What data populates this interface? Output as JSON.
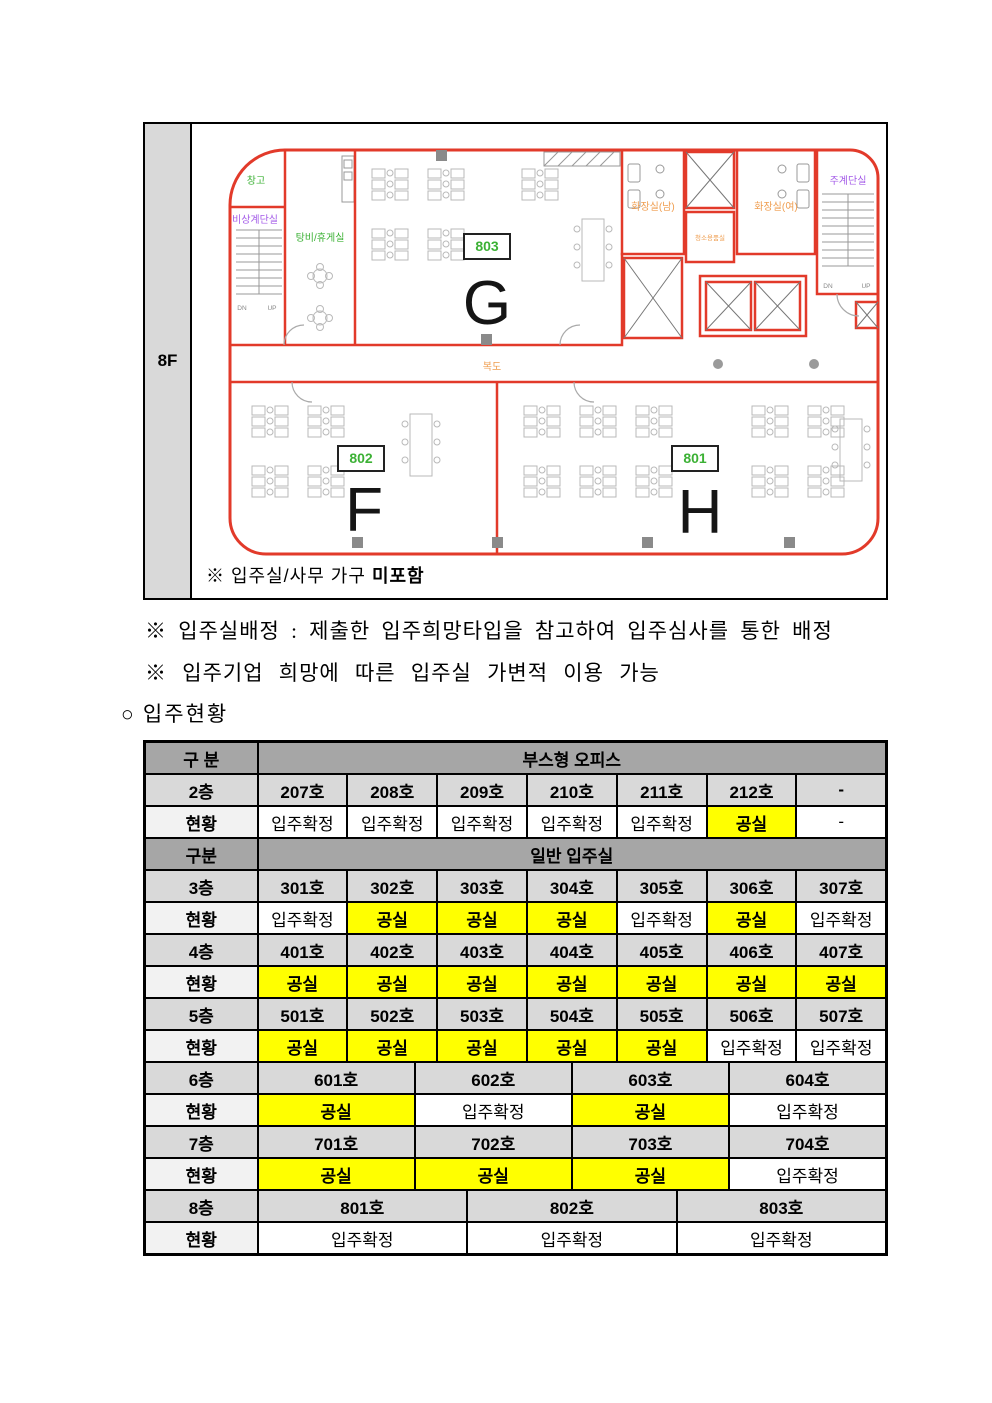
{
  "floor_plan": {
    "floor_label": "8F",
    "note": {
      "prefix": "※ 입주실/사무 가구 ",
      "bold": "미포함"
    },
    "labels": {
      "storage": "창고",
      "emergency_stairs": "비상계단실",
      "pantry": "탕비/휴게실",
      "toilet_men": "화장실(남)",
      "toilet_women": "화장실(여)",
      "cleaning_room": "청소용품실",
      "main_stairs": "주계단실",
      "corridor": "복도",
      "dn": "DN",
      "up": "UP"
    },
    "rooms": [
      {
        "number": "803",
        "letter": "G"
      },
      {
        "number": "802",
        "letter": "F"
      },
      {
        "number": "801",
        "letter": "H"
      }
    ],
    "colors": {
      "wall_red": "#e23a2a",
      "label_green": "#3cb135",
      "label_purple": "#a45ce8",
      "label_orange": "#ef9d4f",
      "furniture_gray": "#b9b9b9"
    }
  },
  "notes": [
    "※ 입주실배정 : 제출한 입주희망타입을 참고하여 입주심사를 통한 배정",
    "※ 입주기업 희망에 따른 입주실 가변적 이용 가능"
  ],
  "section_title": "○ 입주현황",
  "table": {
    "colors": {
      "header_bg": "#a6a6a6",
      "floor_bg": "#d9d9d9",
      "status_label_bg": "#f2f2f2",
      "vacant_bg": "#ffff00"
    },
    "rows": [
      {
        "type": "header",
        "label": "구 분",
        "value": "부스형 오피스"
      },
      {
        "type": "floors",
        "label": "2층",
        "cells": [
          {
            "t": "207호"
          },
          {
            "t": "208호"
          },
          {
            "t": "209호"
          },
          {
            "t": "210호"
          },
          {
            "t": "211호"
          },
          {
            "t": "212호"
          },
          {
            "t": "-"
          }
        ]
      },
      {
        "type": "status",
        "label": "현황",
        "cells": [
          {
            "t": "입주확정"
          },
          {
            "t": "입주확정"
          },
          {
            "t": "입주확정"
          },
          {
            "t": "입주확정"
          },
          {
            "t": "입주확정"
          },
          {
            "t": "공실",
            "vacant": true
          },
          {
            "t": "-"
          }
        ]
      },
      {
        "type": "header",
        "label": "구분",
        "value": "일반 입주실"
      },
      {
        "type": "floors",
        "label": "3층",
        "cells": [
          {
            "t": "301호"
          },
          {
            "t": "302호"
          },
          {
            "t": "303호"
          },
          {
            "t": "304호"
          },
          {
            "t": "305호"
          },
          {
            "t": "306호"
          },
          {
            "t": "307호"
          }
        ]
      },
      {
        "type": "status",
        "label": "현황",
        "cells": [
          {
            "t": "입주확정"
          },
          {
            "t": "공실",
            "vacant": true
          },
          {
            "t": "공실",
            "vacant": true
          },
          {
            "t": "공실",
            "vacant": true
          },
          {
            "t": "입주확정"
          },
          {
            "t": "공실",
            "vacant": true
          },
          {
            "t": "입주확정"
          }
        ]
      },
      {
        "type": "floors",
        "label": "4층",
        "cells": [
          {
            "t": "401호"
          },
          {
            "t": "402호"
          },
          {
            "t": "403호"
          },
          {
            "t": "404호"
          },
          {
            "t": "405호"
          },
          {
            "t": "406호"
          },
          {
            "t": "407호"
          }
        ]
      },
      {
        "type": "status",
        "label": "현황",
        "cells": [
          {
            "t": "공실",
            "vacant": true
          },
          {
            "t": "공실",
            "vacant": true
          },
          {
            "t": "공실",
            "vacant": true
          },
          {
            "t": "공실",
            "vacant": true
          },
          {
            "t": "공실",
            "vacant": true
          },
          {
            "t": "공실",
            "vacant": true
          },
          {
            "t": "공실",
            "vacant": true
          }
        ]
      },
      {
        "type": "floors",
        "label": "5층",
        "cells": [
          {
            "t": "501호"
          },
          {
            "t": "502호"
          },
          {
            "t": "503호"
          },
          {
            "t": "504호"
          },
          {
            "t": "505호"
          },
          {
            "t": "506호"
          },
          {
            "t": "507호"
          }
        ]
      },
      {
        "type": "status",
        "label": "현황",
        "cells": [
          {
            "t": "공실",
            "vacant": true
          },
          {
            "t": "공실",
            "vacant": true
          },
          {
            "t": "공실",
            "vacant": true
          },
          {
            "t": "공실",
            "vacant": true
          },
          {
            "t": "공실",
            "vacant": true
          },
          {
            "t": "입주확정"
          },
          {
            "t": "입주확정"
          }
        ]
      },
      {
        "type": "floors",
        "label": "6층",
        "cells": [
          {
            "t": "601호",
            "span": 21
          },
          {
            "t": "602호",
            "span": 21
          },
          {
            "t": "603호",
            "span": 21
          },
          {
            "t": "604호",
            "span": 21
          }
        ]
      },
      {
        "type": "status",
        "label": "현황",
        "cells": [
          {
            "t": "공실",
            "span": 21,
            "vacant": true
          },
          {
            "t": "입주확정",
            "span": 21
          },
          {
            "t": "공실",
            "span": 21,
            "vacant": true
          },
          {
            "t": "입주확정",
            "span": 21
          }
        ]
      },
      {
        "type": "floors",
        "label": "7층",
        "cells": [
          {
            "t": "701호",
            "span": 21
          },
          {
            "t": "702호",
            "span": 21
          },
          {
            "t": "703호",
            "span": 21
          },
          {
            "t": "704호",
            "span": 21
          }
        ]
      },
      {
        "type": "status",
        "label": "현황",
        "cells": [
          {
            "t": "공실",
            "span": 21,
            "vacant": true
          },
          {
            "t": "공실",
            "span": 21,
            "vacant": true
          },
          {
            "t": "공실",
            "span": 21,
            "vacant": true
          },
          {
            "t": "입주확정",
            "span": 21
          }
        ]
      },
      {
        "type": "floors",
        "label": "8층",
        "cells": [
          {
            "t": "801호",
            "span": 28
          },
          {
            "t": "802호",
            "span": 28
          },
          {
            "t": "803호",
            "span": 28
          }
        ]
      },
      {
        "type": "status",
        "label": "현황",
        "cells": [
          {
            "t": "입주확정",
            "span": 28
          },
          {
            "t": "입주확정",
            "span": 28
          },
          {
            "t": "입주확정",
            "span": 28
          }
        ]
      }
    ]
  }
}
